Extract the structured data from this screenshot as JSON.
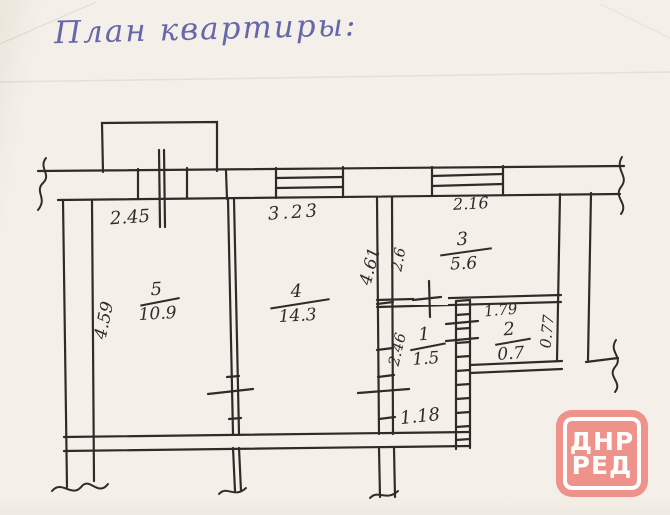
{
  "title": "План квартиры:",
  "rooms": [
    {
      "number": "5",
      "area": "10.9"
    },
    {
      "number": "4",
      "area": "14.3"
    },
    {
      "number": "3",
      "area": "5.6"
    },
    {
      "number": "1",
      "area": "1.5"
    },
    {
      "number": "2",
      "area": "0.7"
    }
  ],
  "dims": {
    "room5_top": "2.45",
    "room4_top": "3.23",
    "room3_top": "2.16",
    "room5_left": "4.59",
    "room4_right": "4.61",
    "room3_left": "2.6",
    "room1_left": "2.46",
    "room2_top": "1.79",
    "room2_right": "0.77",
    "hall_bottom": "1.18"
  },
  "watermark": {
    "line1": "ДНР",
    "line2": "РЕД"
  },
  "colors": {
    "ink": "#2f2b27",
    "title_ink": "#6667ab",
    "watermark_red": "#ee8e87",
    "paper": "#f4f0e9"
  }
}
